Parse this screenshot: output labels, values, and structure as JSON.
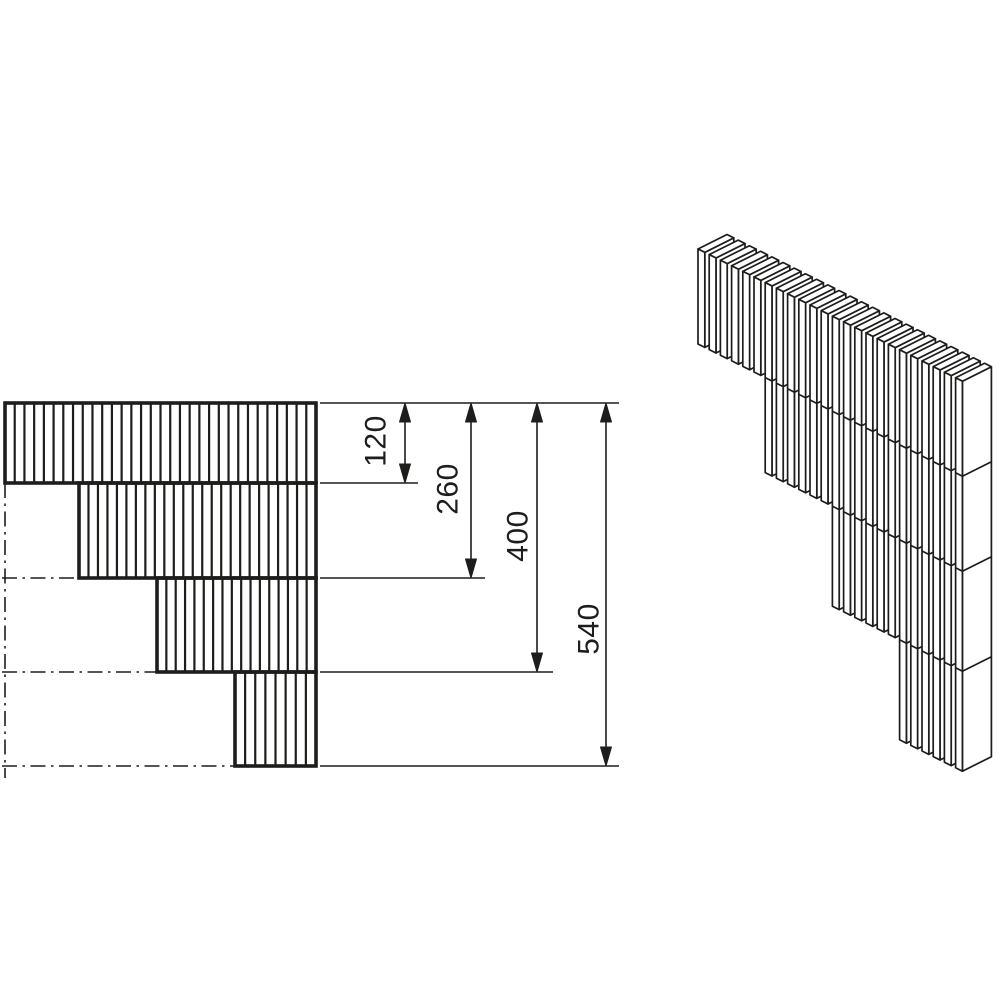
{
  "page": {
    "background": "#ffffff",
    "stroke_color": "#1d1d1b"
  },
  "drawing": {
    "kind": "stepped-slat-block-dimension-drawing",
    "dimensions": [
      {
        "label": "120",
        "value": 120,
        "line_x": 405,
        "y_from": 403,
        "y_to": 483,
        "ext_x_end": 418,
        "label_cx": 376,
        "label_cy": 441
      },
      {
        "label": "260",
        "value": 260,
        "line_x": 471,
        "y_from": 403,
        "y_to": 578,
        "ext_x_end": 485,
        "label_cx": 448,
        "label_cy": 489
      },
      {
        "label": "400",
        "value": 400,
        "line_x": 537,
        "y_from": 403,
        "y_to": 672,
        "ext_x_end": 553,
        "label_cx": 518,
        "label_cy": 536
      },
      {
        "label": "540",
        "value": 540,
        "line_x": 606,
        "y_from": 403,
        "y_to": 766,
        "ext_x_end": 619,
        "label_cx": 589,
        "label_cy": 629
      }
    ],
    "front_view": {
      "x_left": 5,
      "x_right": 316,
      "y_top": 403,
      "bands": [
        {
          "left": 5,
          "top": 403,
          "bottom": 483
        },
        {
          "left": 79,
          "top": 483,
          "bottom": 578
        },
        {
          "left": 157,
          "top": 578,
          "bottom": 672
        },
        {
          "left": 235,
          "top": 672,
          "bottom": 766
        }
      ],
      "hatch_pitch": 9.6,
      "border_width": 3.6,
      "hatch_width": 2.2,
      "thin_width": 1.6,
      "centerline_vertical": {
        "x": 5,
        "y_start": 483,
        "y_end": 778
      },
      "centerlines_horizontal": [
        {
          "y": 578,
          "x_start": 2,
          "x_end": 79
        },
        {
          "y": 672,
          "x_start": 2,
          "x_end": 157
        },
        {
          "y": 766,
          "x_start": 2,
          "x_end": 235
        }
      ],
      "top_extension": {
        "y": 403,
        "x_start": 320,
        "x_end": 619
      }
    },
    "iso_view": {
      "origin_x": 698,
      "origin_y": 249,
      "slat_count": 24,
      "group_size": 6,
      "pitch_x": 11.2,
      "pitch_y": 5.6,
      "thick_x": 6.8,
      "thick_y": 3.4,
      "depth_x": 29,
      "depth_y": -14.5,
      "group_heights": [
        95,
        190,
        290,
        390
      ],
      "stroke_width": 1.7
    }
  }
}
